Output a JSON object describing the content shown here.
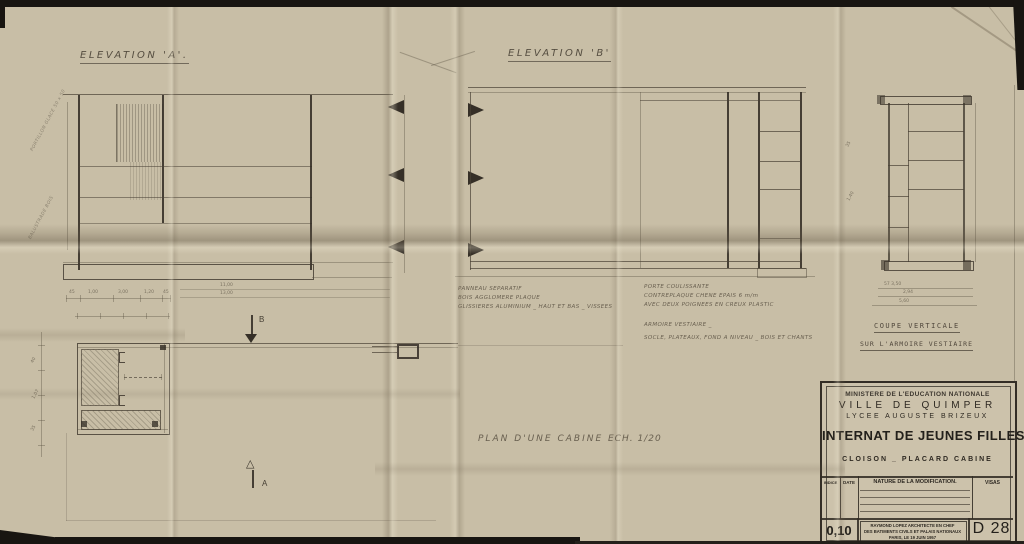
{
  "drawing": {
    "elevation_a_title": "ELEVATION  'A'.",
    "elevation_b_title": "ELEVATION  'B'",
    "coupe_title_1": "COUPE VERTICALE",
    "coupe_title_2": "SUR L'ARMOIRE VESTIAIRE",
    "plan_title": "PLAN D'UNE CABINE",
    "plan_scale": "ECH. 1/20",
    "section_marker_b": "B",
    "section_marker_a": "A"
  },
  "notes": {
    "panel": [
      "PANNEAU SEPARATIF",
      "BOIS AGGLOMERE PLAQUE",
      "GLISSIERES ALUMINIUM _ HAUT ET BAS _ VISSEES"
    ],
    "door": [
      "PORTE COULISSANTE",
      "CONTREPLAQUE CHENE EPAIS 6 m/m",
      "AVEC DEUX POIGNEES EN CREUX PLASTIC"
    ],
    "wardrobe": [
      "ARMOIRE VESTIAIRE _",
      "SOCLE, PLATEAUX, FOND A NIVEAU _ BOIS ET CHANTS"
    ],
    "elev_a_side": [
      "PORTILLON GLACE 50 x 50",
      "BALUSTRADE BOIS"
    ]
  },
  "dims": {
    "elev_a_chain": [
      "45",
      "1,00",
      "3,00",
      "1,20",
      "45"
    ],
    "elev_a_totals": [
      "11,00",
      "13,00"
    ],
    "coupe_rows": [
      "57      3,50",
      "2,94",
      "5,60"
    ],
    "coupe_side": [
      "35",
      "1,40"
    ],
    "plan_side": [
      "40",
      "1,07",
      "35"
    ]
  },
  "title_block": {
    "ministry": "MINISTERE DE L'EDUCATION NATIONALE",
    "city": "VILLE DE QUIMPER",
    "school": "LYCEE AUGUSTE BRIZEUX",
    "project": "INTERNAT DE JEUNES FILLES.",
    "subject": "CLOISON _ PLACARD CABINE",
    "headers": {
      "indice": "INDICE",
      "date": "DATE",
      "nature": "NATURE DE LA MODIFICATION.",
      "visas": "VISAS"
    },
    "scale": "0,10",
    "architect_1": "RAYMOND LOPEZ ARCHITECTE EN CHEF",
    "architect_2": "DES BATIMENTS CIVILS ET PALAIS NATIONAUX",
    "architect_3": "PARIS, LE 19 JUIN 1957",
    "number": "D 28"
  },
  "colors": {
    "paper": "#c8bea6",
    "pencil": "#6b6254",
    "dark_line": "#352f27",
    "stamp_ink": "#2e2922"
  }
}
